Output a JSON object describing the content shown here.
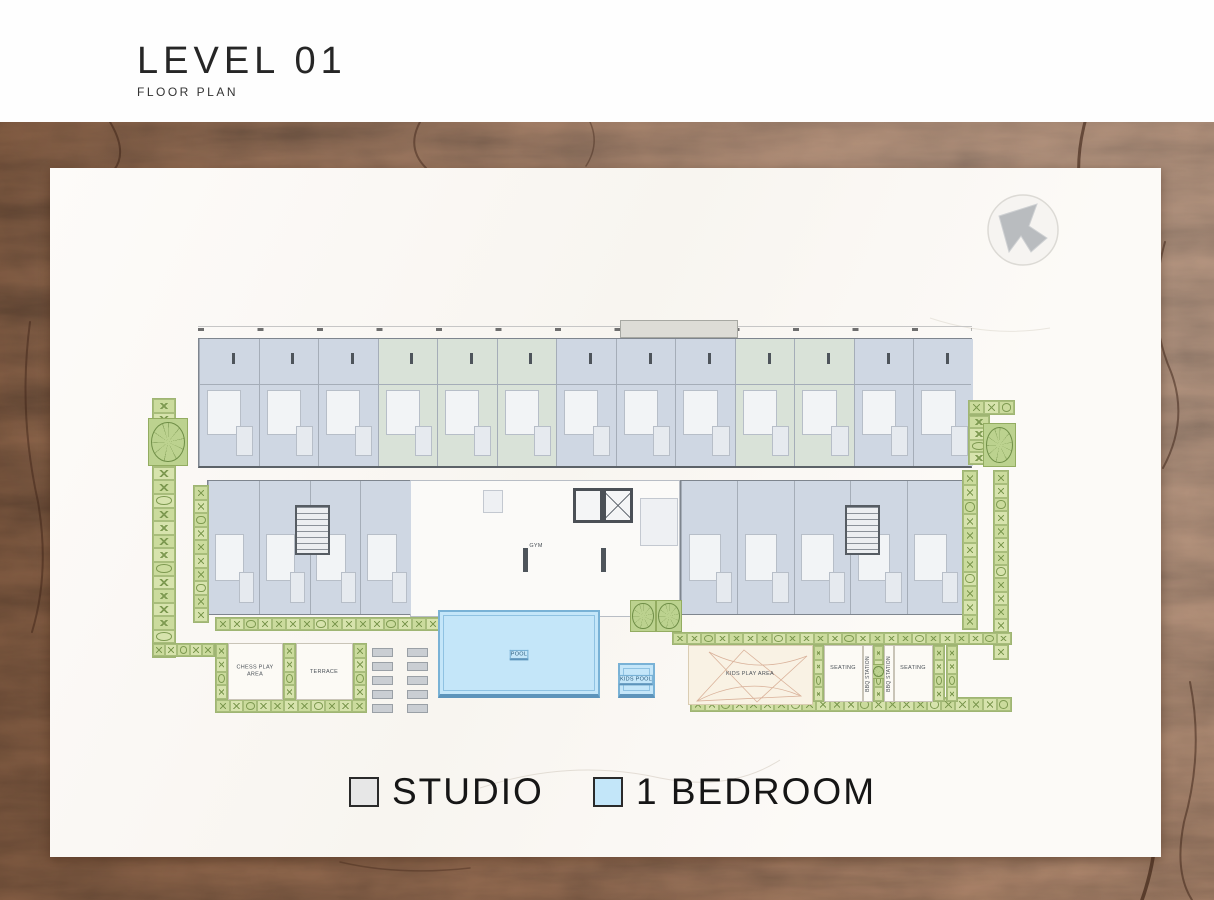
{
  "header": {
    "title": "LEVEL 01",
    "subtitle": "FLOOR PLAN"
  },
  "legend": {
    "items": [
      {
        "label": "STUDIO",
        "color": "#e7e7e7"
      },
      {
        "label": "1 BEDROOM",
        "color": "#c3e6f9"
      }
    ]
  },
  "north_arrow": {
    "name": "north-arrow"
  },
  "colors": {
    "unit_studio": "#cfd7e3",
    "unit_one_bedroom": "#c3e6f9",
    "unit_green_tint": "#d9e2d8",
    "landscape": "#cddc9e",
    "pool_fill": "#c4e6f9",
    "pool_border": "#79b2d6",
    "wood_background": "#a3755a"
  },
  "plan": {
    "top_bar": {
      "x": 148,
      "y": 170,
      "w": 774,
      "h": 130,
      "cols": 13,
      "band": 45,
      "green_cols": [
        3,
        4,
        5,
        9,
        10
      ]
    },
    "protrusion": {
      "x": 570,
      "y": 152,
      "w": 118,
      "h": 18
    },
    "dim_line": {
      "x": 148,
      "y": 158,
      "w": 774,
      "h": 6
    },
    "central": {
      "x": 360,
      "y": 312,
      "w": 270,
      "h": 137
    },
    "faint_rooms": [
      [
        433,
        322,
        20,
        23
      ],
      [
        590,
        330,
        38,
        48
      ]
    ],
    "wings": [
      {
        "x": 157,
        "y": 312,
        "w": 203,
        "h": 135,
        "cols": 4
      },
      {
        "x": 630,
        "y": 312,
        "w": 282,
        "h": 135,
        "cols": 5
      }
    ],
    "stairs": [
      [
        245,
        337,
        35,
        50
      ],
      [
        795,
        337,
        35,
        50
      ]
    ],
    "lifts": {
      "x": 523,
      "y": 320,
      "w": 60,
      "h": 35
    },
    "pillars": [
      [
        473,
        380,
        5,
        24
      ],
      [
        551,
        380,
        5,
        24
      ]
    ],
    "strips": [
      [
        102,
        230,
        24,
        260
      ],
      [
        143,
        317,
        16,
        138
      ],
      [
        918,
        232,
        47,
        15
      ],
      [
        918,
        247,
        22,
        50
      ],
      [
        943,
        302,
        16,
        190
      ],
      [
        912,
        302,
        16,
        160
      ],
      [
        165,
        449,
        240,
        14
      ],
      [
        622,
        464,
        340,
        13
      ],
      [
        165,
        531,
        152,
        14
      ],
      [
        640,
        529,
        322,
        15
      ],
      [
        102,
        475,
        63,
        14
      ],
      [
        165,
        475,
        13,
        57
      ],
      [
        233,
        475,
        13,
        57
      ],
      [
        303,
        475,
        14,
        57
      ],
      [
        763,
        477,
        11,
        57
      ],
      [
        823,
        477,
        11,
        57
      ],
      [
        883,
        477,
        12,
        57
      ],
      [
        896,
        477,
        12,
        57
      ]
    ],
    "tree_squares": [
      [
        98,
        250,
        40,
        48
      ],
      [
        933,
        255,
        33,
        44
      ],
      [
        580,
        432,
        26,
        32
      ],
      [
        606,
        432,
        26,
        32
      ],
      [
        821,
        496,
        15,
        15
      ]
    ],
    "amenity_boxes": [
      {
        "rect": [
          178,
          475,
          55,
          57
        ],
        "name": "chess-play-area"
      },
      {
        "rect": [
          246,
          475,
          57,
          57
        ],
        "name": "terrace"
      },
      {
        "rect": [
          638,
          477,
          125,
          60
        ],
        "name": "kids-play-area",
        "sails": true
      },
      {
        "rect": [
          774,
          477,
          39,
          57
        ],
        "name": "seating-1"
      },
      {
        "rect": [
          813,
          477,
          10,
          57
        ],
        "name": "bbq-station-1"
      },
      {
        "rect": [
          834,
          477,
          10,
          57
        ],
        "name": "bbq-station-2"
      },
      {
        "rect": [
          844,
          477,
          39,
          57
        ],
        "name": "seating-2"
      }
    ],
    "pool": {
      "rect": [
        388,
        442,
        162,
        88
      ],
      "label": "POOL"
    },
    "kids_pool": {
      "rect": [
        568,
        495,
        37,
        35
      ],
      "label": "KIDS POOL"
    },
    "loungers": {
      "cols": [
        322,
        357
      ],
      "rows": [
        480,
        494,
        508,
        522,
        536
      ],
      "w": 21,
      "h": 9
    },
    "labels": [
      {
        "text": "GYM",
        "x": 486,
        "y": 378
      },
      {
        "text": "POOL",
        "x": 469,
        "y": 487,
        "cls": "pool"
      },
      {
        "text": "KIDS POOL",
        "x": 586,
        "y": 512,
        "cls": "pool"
      },
      {
        "text": "CHESS PLAY\nAREA",
        "x": 205,
        "y": 503
      },
      {
        "text": "TERRACE",
        "x": 274,
        "y": 504
      },
      {
        "text": "KIDS PLAY AREA",
        "x": 700,
        "y": 506
      },
      {
        "text": "SEATING",
        "x": 793,
        "y": 500
      },
      {
        "text": "SEATING",
        "x": 863,
        "y": 500
      },
      {
        "text": "BBQ STATION",
        "x": 818,
        "y": 506,
        "rot": true
      },
      {
        "text": "BBQ STATION",
        "x": 839,
        "y": 506,
        "rot": true
      }
    ]
  }
}
